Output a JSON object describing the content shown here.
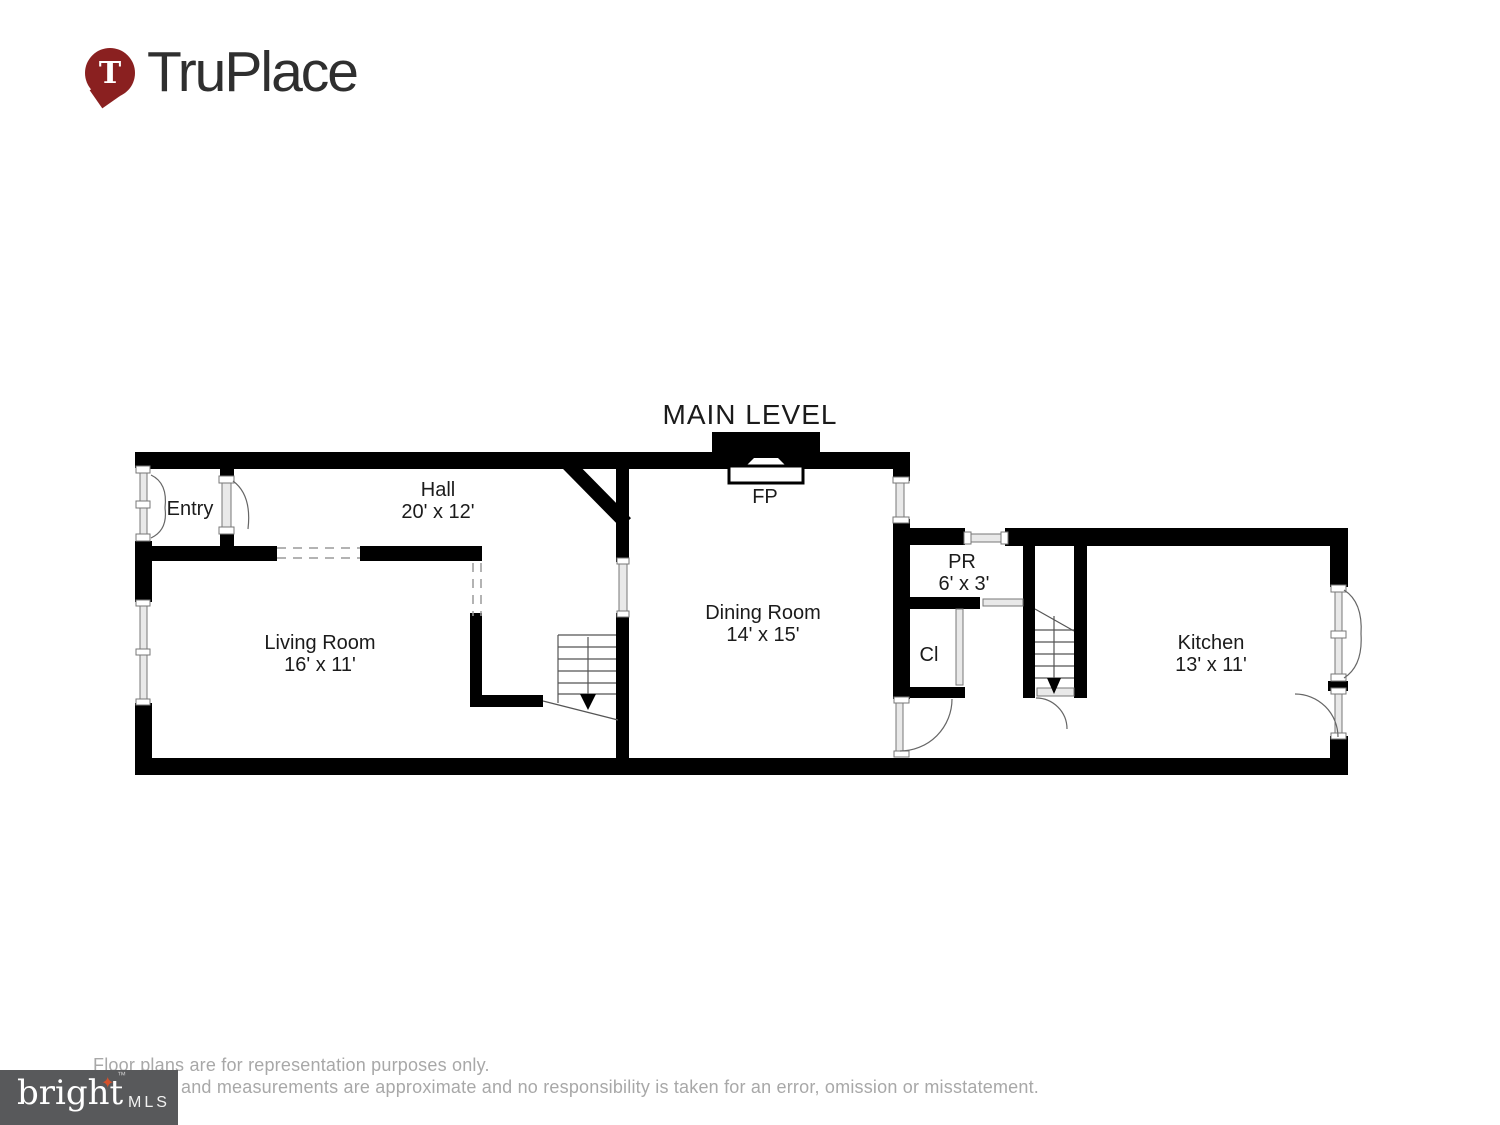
{
  "brand": {
    "name": "TruPlace",
    "pin_letter": "T"
  },
  "plan": {
    "title": "MAIN LEVEL",
    "rooms": {
      "entry": {
        "name": "Entry"
      },
      "hall": {
        "name": "Hall",
        "dims": "20' x 12'"
      },
      "living_room": {
        "name": "Living Room",
        "dims": "16' x 11'"
      },
      "dining_room": {
        "name": "Dining Room",
        "dims": "14' x 15'"
      },
      "fireplace": {
        "abbr": "FP"
      },
      "powder_room": {
        "abbr": "PR",
        "dims": "6' x 3'"
      },
      "closet": {
        "abbr": "Cl"
      },
      "kitchen": {
        "name": "Kitchen",
        "dims": "13' x 11'"
      }
    }
  },
  "footer": {
    "mls_logo": {
      "text": "bright",
      "suffix": "MLS",
      "trademark": "™",
      "star": "✦"
    },
    "disclaimer_line1": "Floor plans are for representation purposes only.",
    "disclaimer_line2": "and measurements are approximate and no responsibility is taken for an error, omission or misstatement."
  },
  "colors": {
    "wall": "#000000",
    "pin": "#8a2020",
    "mls_box": "#58595b",
    "star": "#d4512b",
    "disclaimer_text": "#a8a8a8"
  }
}
